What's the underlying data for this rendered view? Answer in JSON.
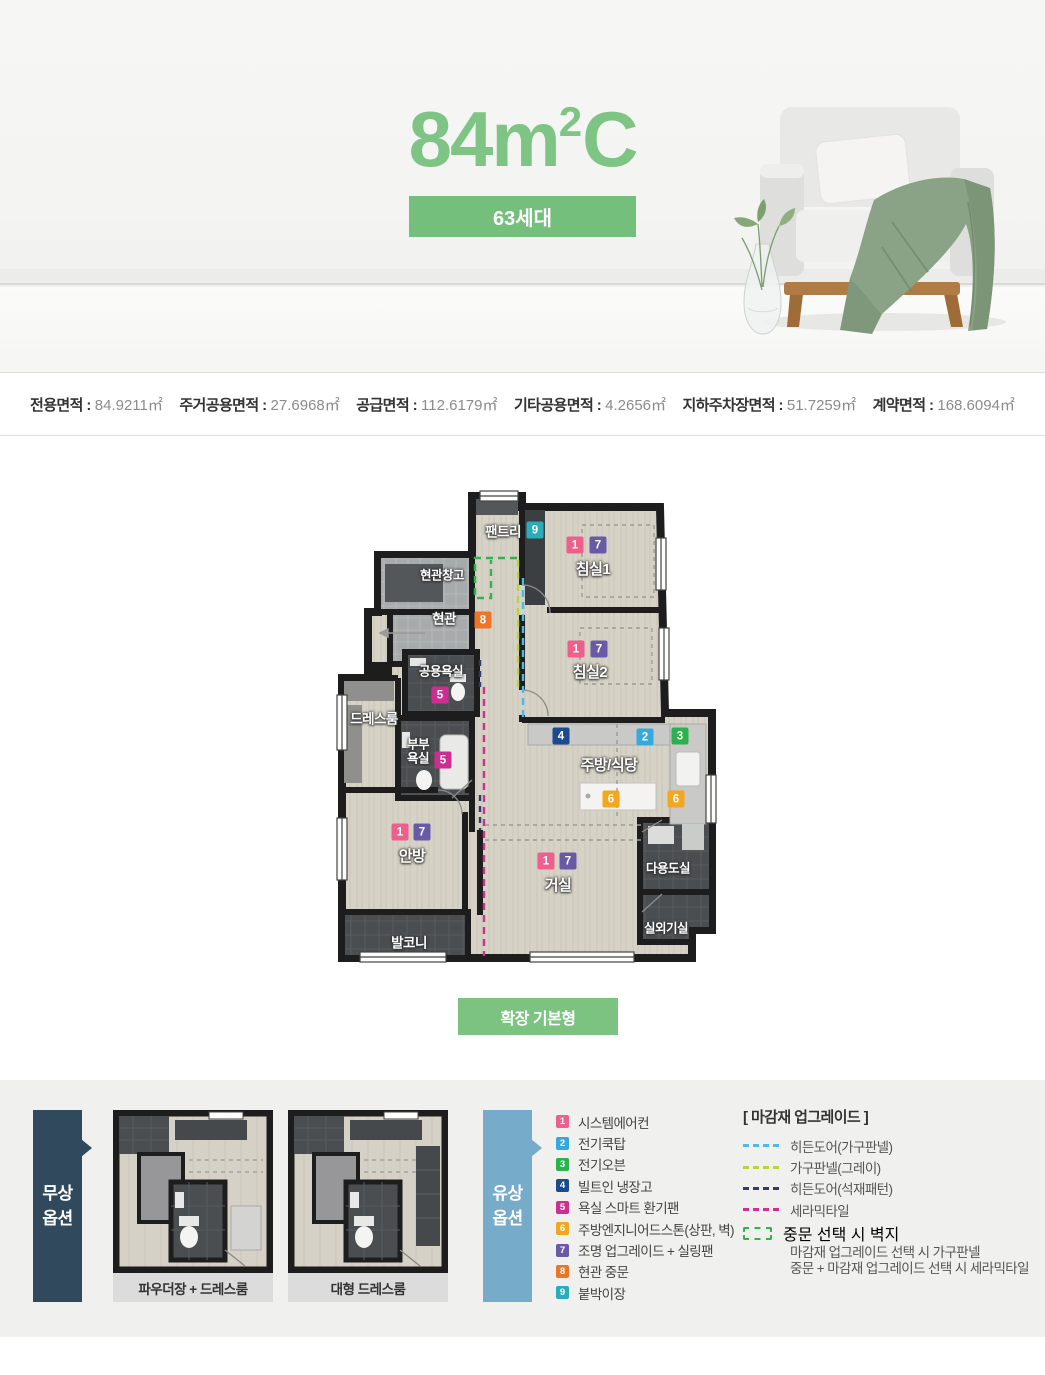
{
  "header": {
    "title": {
      "main": "84m",
      "sup": "2",
      "tail": "C"
    },
    "units_badge": "63세대"
  },
  "colors": {
    "title_green": "#7ec585",
    "badge_green": "#74bf7c",
    "button_green": "#7cc382",
    "free_tab": "#31495c",
    "paid_tab": "#76abc9"
  },
  "area_info": [
    {
      "label": "전용면적 :",
      "value": "84.9211㎡"
    },
    {
      "label": "주거공용면적 :",
      "value": "27.6968㎡"
    },
    {
      "label": "공급면적 :",
      "value": "112.6179㎡"
    },
    {
      "label": "기타공용면적 :",
      "value": "4.2656㎡"
    },
    {
      "label": "지하주차장면적 :",
      "value": "51.7259㎡"
    },
    {
      "label": "계약면적 :",
      "value": "168.6094㎡"
    }
  ],
  "floor_plan": {
    "rooms": {
      "pantry": "팬트리",
      "entry_storage": "현관창고",
      "entry": "현관",
      "bedroom1": "침실1",
      "bedroom2": "침실2",
      "bath_common": "공용욕실",
      "dressroom": "드레스룸",
      "bath_master": "부부\n욕실",
      "kitchen": "주방/식당",
      "master": "안방",
      "living": "거실",
      "utility": "다용도실",
      "outdoor_unit": "실외기실",
      "balcony": "발코니"
    },
    "expand_button": "확장 기본형"
  },
  "plan_badges": [
    {
      "n": "9",
      "color": "#2aacba"
    },
    {
      "n": "1",
      "color": "#ee5f8b"
    },
    {
      "n": "7",
      "color": "#6a5aa6"
    },
    {
      "n": "8",
      "color": "#ee7428"
    },
    {
      "n": "5",
      "color": "#cc2e92"
    },
    {
      "n": "5",
      "color": "#cc2e92"
    },
    {
      "n": "1",
      "color": "#ee5f8b"
    },
    {
      "n": "7",
      "color": "#6a5aa6"
    },
    {
      "n": "4",
      "color": "#1b4a8e"
    },
    {
      "n": "2",
      "color": "#35a8dc"
    },
    {
      "n": "3",
      "color": "#2cb24c"
    },
    {
      "n": "6",
      "color": "#f4a71e"
    },
    {
      "n": "6",
      "color": "#f4a71e"
    },
    {
      "n": "1",
      "color": "#ee5f8b"
    },
    {
      "n": "7",
      "color": "#6a5aa6"
    },
    {
      "n": "1",
      "color": "#ee5f8b"
    },
    {
      "n": "7",
      "color": "#6a5aa6"
    }
  ],
  "options": {
    "free": {
      "tab_line1": "무상",
      "tab_line2": "옵션",
      "captions": [
        "파우더장 + 드레스룸",
        "대형 드레스룸"
      ]
    },
    "paid": {
      "tab_line1": "유상",
      "tab_line2": "옵션",
      "items": [
        {
          "n": "1",
          "label": "시스템에어컨",
          "color": "#ee5f8b"
        },
        {
          "n": "2",
          "label": "전기쿡탑",
          "color": "#35a8dc"
        },
        {
          "n": "3",
          "label": "전기오븐",
          "color": "#2cb24c"
        },
        {
          "n": "4",
          "label": "빌트인 냉장고",
          "color": "#1b4a8e"
        },
        {
          "n": "5",
          "label": "욕실 스마트 환기팬",
          "color": "#cc2e92"
        },
        {
          "n": "6",
          "label": "주방엔지니어드스톤(상판, 벽)",
          "color": "#f4a71e"
        },
        {
          "n": "7",
          "label": "조명 업그레이드 + 실링팬",
          "color": "#6a5aa6"
        },
        {
          "n": "8",
          "label": "현관 중문",
          "color": "#ee7428"
        },
        {
          "n": "9",
          "label": "붙박이장",
          "color": "#2aacba"
        }
      ]
    },
    "finish": {
      "title": "[ 마감재 업그레이드 ]",
      "lines": [
        {
          "label": "히든도어(가구판넬)",
          "color": "#4fb8e8"
        },
        {
          "label": "가구판넬(그레이)",
          "color": "#b6d43b"
        },
        {
          "label": "히든도어(석재패턴)",
          "color": "#2e3b74"
        },
        {
          "label": "세라믹타일",
          "color": "#d62d8d"
        }
      ],
      "box": {
        "color": "#2eb34d",
        "line1": "중문 선택 시 벽지",
        "line2": "마감재 업그레이드 선택 시 가구판넬",
        "line3": "중문 + 마감재 업그레이드 선택 시 세라믹타일"
      }
    }
  }
}
